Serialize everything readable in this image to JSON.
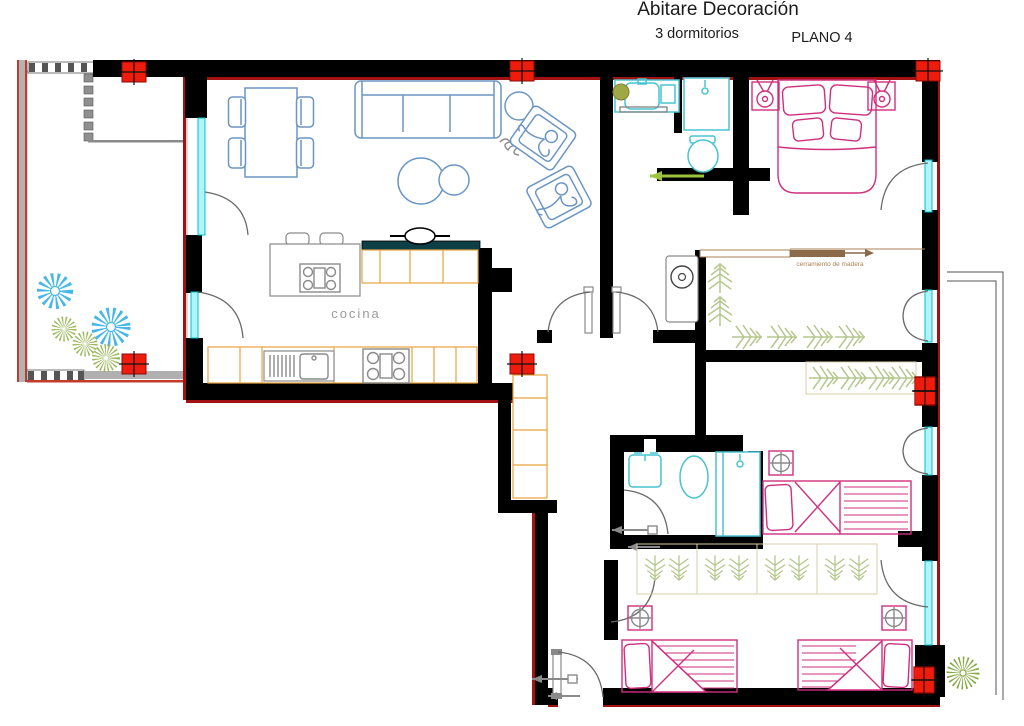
{
  "title": {
    "main": "Abitare Decoración",
    "subtitle": "3 dormitorios",
    "plan_label": "PLANO 4"
  },
  "labels": {
    "kitchen": "cocina",
    "wood_partition": "cerramiento de madera"
  },
  "colors": {
    "wall_black": "#000000",
    "accent_dark_red": "#a31212",
    "column_red": "#ee1c0c",
    "window_cyan": "#00c0d4",
    "living_furniture_blue": "#6b96c4",
    "bath_fixture_teal": "#49c3d2",
    "bedroom_magenta": "#cf2f7e",
    "kitchen_counter_orange": "#e8a33d",
    "plant_green": "#9cb85c",
    "hanger_green": "#b6c78e",
    "plant_blue": "#45b7e8",
    "wood_brown": "#a98253",
    "neutral_gray": "#8a8a8a"
  },
  "icons": [
    "column-marker-icon",
    "window-icon",
    "door-swing-icon",
    "double-door-swing-icon",
    "dining-table-icon",
    "chair-icon",
    "sofa-icon",
    "coffee-table-icon",
    "armchair-icon",
    "person-icon",
    "bar-stool-icon",
    "kitchen-island-icon",
    "cooktop-icon",
    "kitchen-sink-icon",
    "extractor-hood-icon",
    "bath-sink-icon",
    "toilet-icon",
    "shower-icon",
    "washer-icon",
    "double-bed-icon",
    "single-bed-icon",
    "nightstand-lamp-icon",
    "ceiling-light-icon",
    "clothes-hanger-icon",
    "wardrobe-icon",
    "wood-rod-arrow-icon",
    "sliding-door-arrow-icon",
    "terrace-plant-icon",
    "fern-plant-icon",
    "checker-paving-icon",
    "balcony-outline-icon"
  ]
}
